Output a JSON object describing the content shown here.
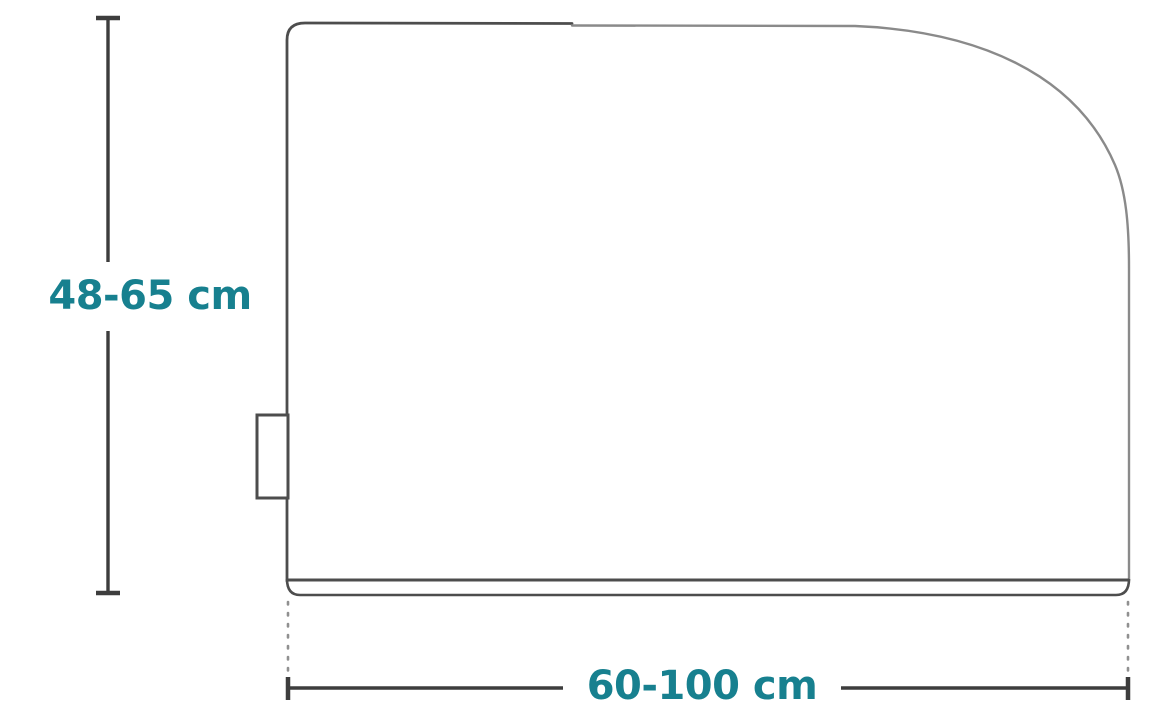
{
  "diagram": {
    "type": "dimension-drawing",
    "subject": "appliance-cover-side-profile",
    "height_label": "48-65 cm",
    "width_label": "60-100 cm"
  },
  "colors": {
    "label_teal": "#17808F",
    "dimension_line": "#3d3d3d",
    "outline_dark": "#4d4d4d",
    "outline_light": "#8a8a8a",
    "extension_dotted": "#909090",
    "background": "#ffffff"
  }
}
